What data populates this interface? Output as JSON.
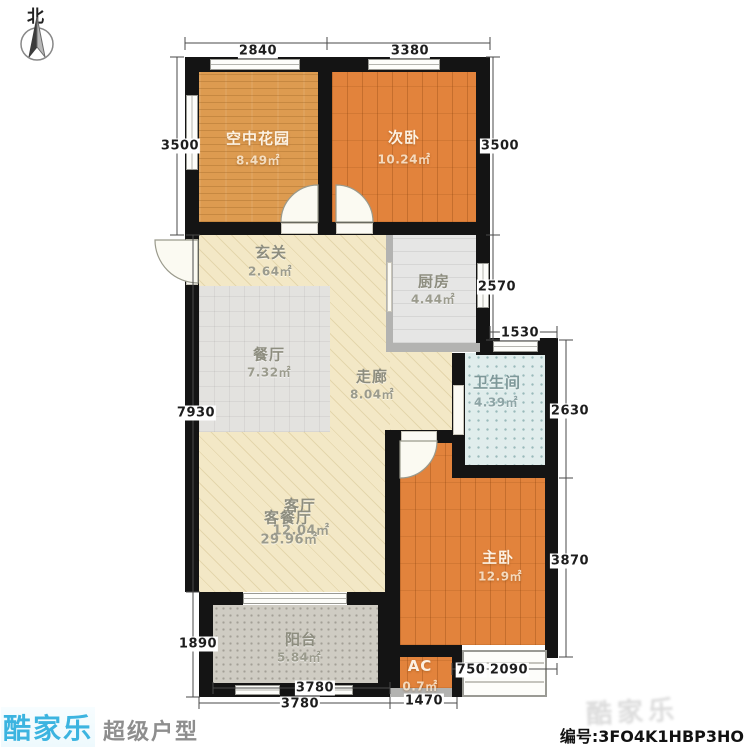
{
  "compass": {
    "label": "北"
  },
  "rooms": {
    "garden": {
      "name": "空中花园",
      "area": "8.49㎡"
    },
    "bedroom2": {
      "name": "次卧",
      "area": "10.24㎡"
    },
    "hallway": {
      "name": "玄关",
      "area": "2.64㎡"
    },
    "kitchen": {
      "name": "厨房",
      "area": "4.44㎡"
    },
    "dining": {
      "name": "餐厅",
      "area": "7.32㎡"
    },
    "corridor": {
      "name": "走廊",
      "area": "8.04㎡"
    },
    "bathroom": {
      "name": "卫生间",
      "area": "4.39㎡"
    },
    "living": {
      "name": "客厅",
      "area": "12.04㎡"
    },
    "living_dining": {
      "name": "客餐厅",
      "area": "29.96㎡"
    },
    "master": {
      "name": "主卧",
      "area": "12.9㎡"
    },
    "balcony": {
      "name": "阳台",
      "area": "5.84㎡"
    },
    "ac": {
      "name": "AC",
      "area": "0.7㎡"
    }
  },
  "dimensions": {
    "top_garden": "2840",
    "top_bedroom2": "3380",
    "left_upper": "3500",
    "right_upper": "3500",
    "right_kitchen": "2570",
    "bath_top": "1530",
    "right_bath": "2630",
    "right_master": "3870",
    "left_main": "7930",
    "left_balcony": "1890",
    "bottom_balcony_inner": "3780",
    "bottom_balcony_outer": "3780",
    "bottom_ac": "1470",
    "bottom_master_left": "750",
    "bottom_master_right": "2090"
  },
  "footer": {
    "brand": "酷家乐",
    "brand_suffix": "超级户型",
    "watermark": "酷家乐",
    "serial": "编号:3FO4K1HBP3HO"
  },
  "colors": {
    "wall": "#141414",
    "wood_floor": "#e2833c",
    "garden_floor": "#dd9b50",
    "cream_floor": "#f3e8c6",
    "bath_floor": "#e0edec",
    "brand_cyan": "#3cb4e0"
  }
}
